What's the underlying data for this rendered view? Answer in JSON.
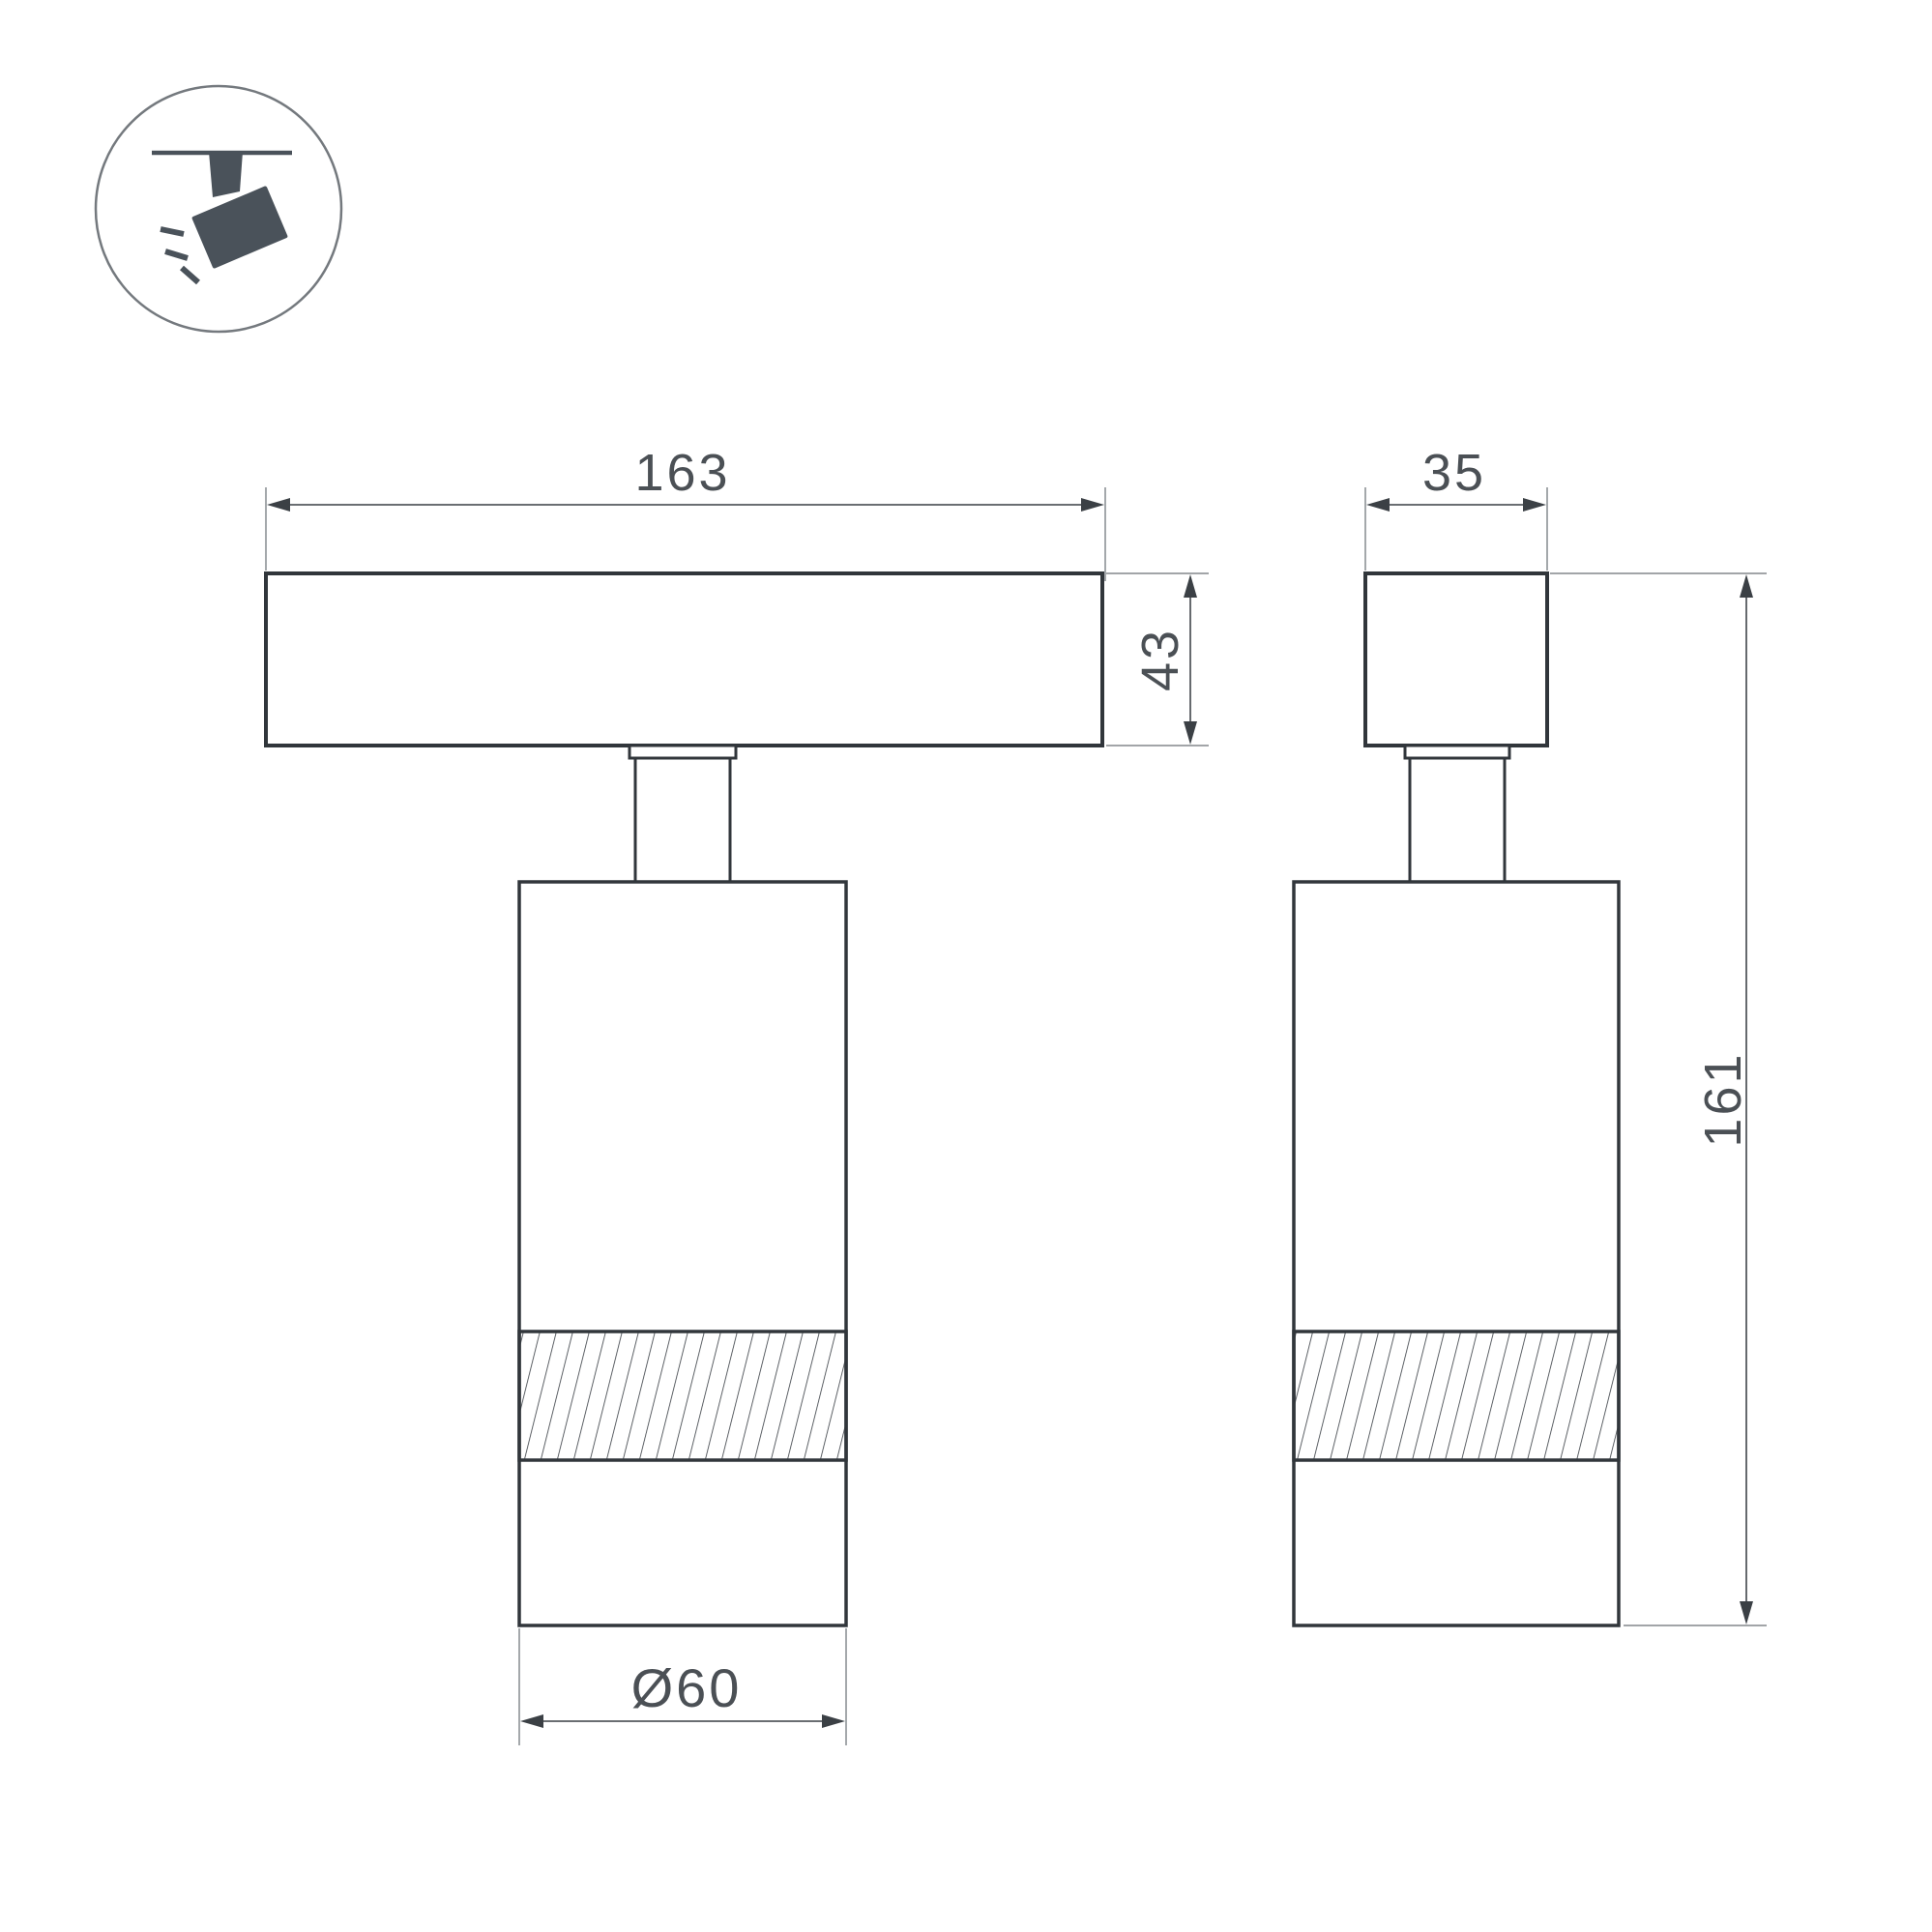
{
  "drawing": {
    "kind": "dimension-drawing",
    "views": [
      "front",
      "side"
    ]
  },
  "icon": {
    "name": "track-spotlight-icon",
    "description": "ceiling track with tilted spotlight head emitting rays"
  },
  "dimensions": {
    "track_length": "163",
    "track_height": "43",
    "side_width": "35",
    "total_height": "161",
    "body_diameter": "Ø60"
  },
  "colors": {
    "background": "#ffffff",
    "outline": "#31363b",
    "dimension_line": "#55595e",
    "extension_line": "#94989c",
    "dimension_text": "#4b5055",
    "arrow": "#3b4045",
    "icon_glyph": "#4a525a",
    "icon_circle": "#74797e",
    "hatch_line": "#41464c"
  }
}
